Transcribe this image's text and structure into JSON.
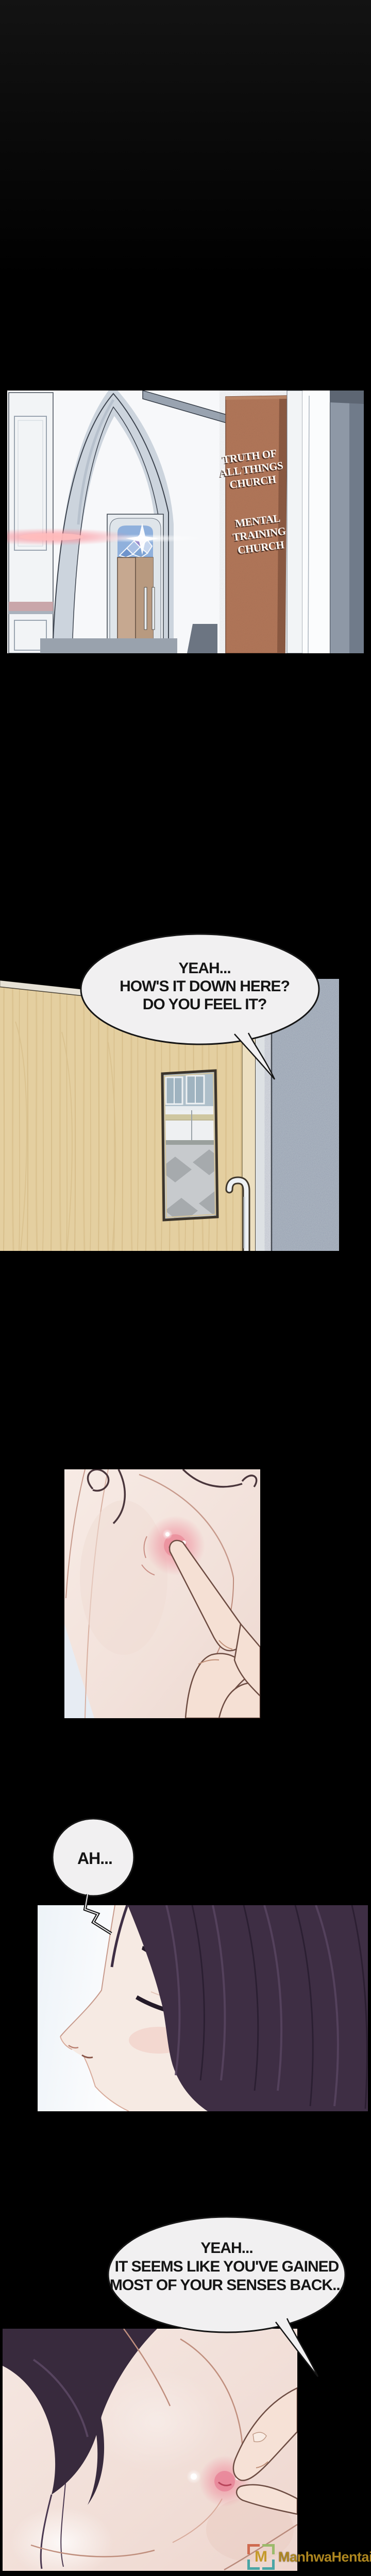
{
  "church_sign": {
    "block1": [
      "TRUTH OF",
      "ALL THINGS",
      "CHURCH"
    ],
    "block2": [
      "MENTAL",
      "TRAINING",
      "CHURCH"
    ],
    "board_color": "#b5795b",
    "text_color": "#fdfcf9"
  },
  "bubbles": {
    "b1": {
      "lines": [
        "YEAH...",
        "HOW'S IT DOWN HERE?",
        "DO YOU FEEL IT?"
      ]
    },
    "b2": {
      "lines": [
        "AH..."
      ]
    },
    "b3": {
      "lines": [
        "YEAH...",
        "IT SEEMS LIKE YOU'VE GAINED",
        "MOST OF YOUR SENSES BACK..."
      ]
    }
  },
  "bubble_style": {
    "fill": "#f1f0f1",
    "outline": "#161616",
    "text_color": "#151515"
  },
  "watermark": {
    "logo_letter": "M",
    "site_name": "ManhwaHentai",
    "text_color": "#ae861f",
    "logo_letter_color": "#c59a2a",
    "frame_colors": {
      "top_left": "#cf6b50",
      "top_right": "#9cba6b",
      "bottom": "#4aa5a5"
    }
  },
  "palette": {
    "page_background": "#000000",
    "door_wood": "#e4cfa0",
    "hall_wall": "#b2bcc5",
    "hair_purple": "#3e2e44",
    "skin": "#f4e6df",
    "nipple_pink": "#ef9aa6"
  }
}
